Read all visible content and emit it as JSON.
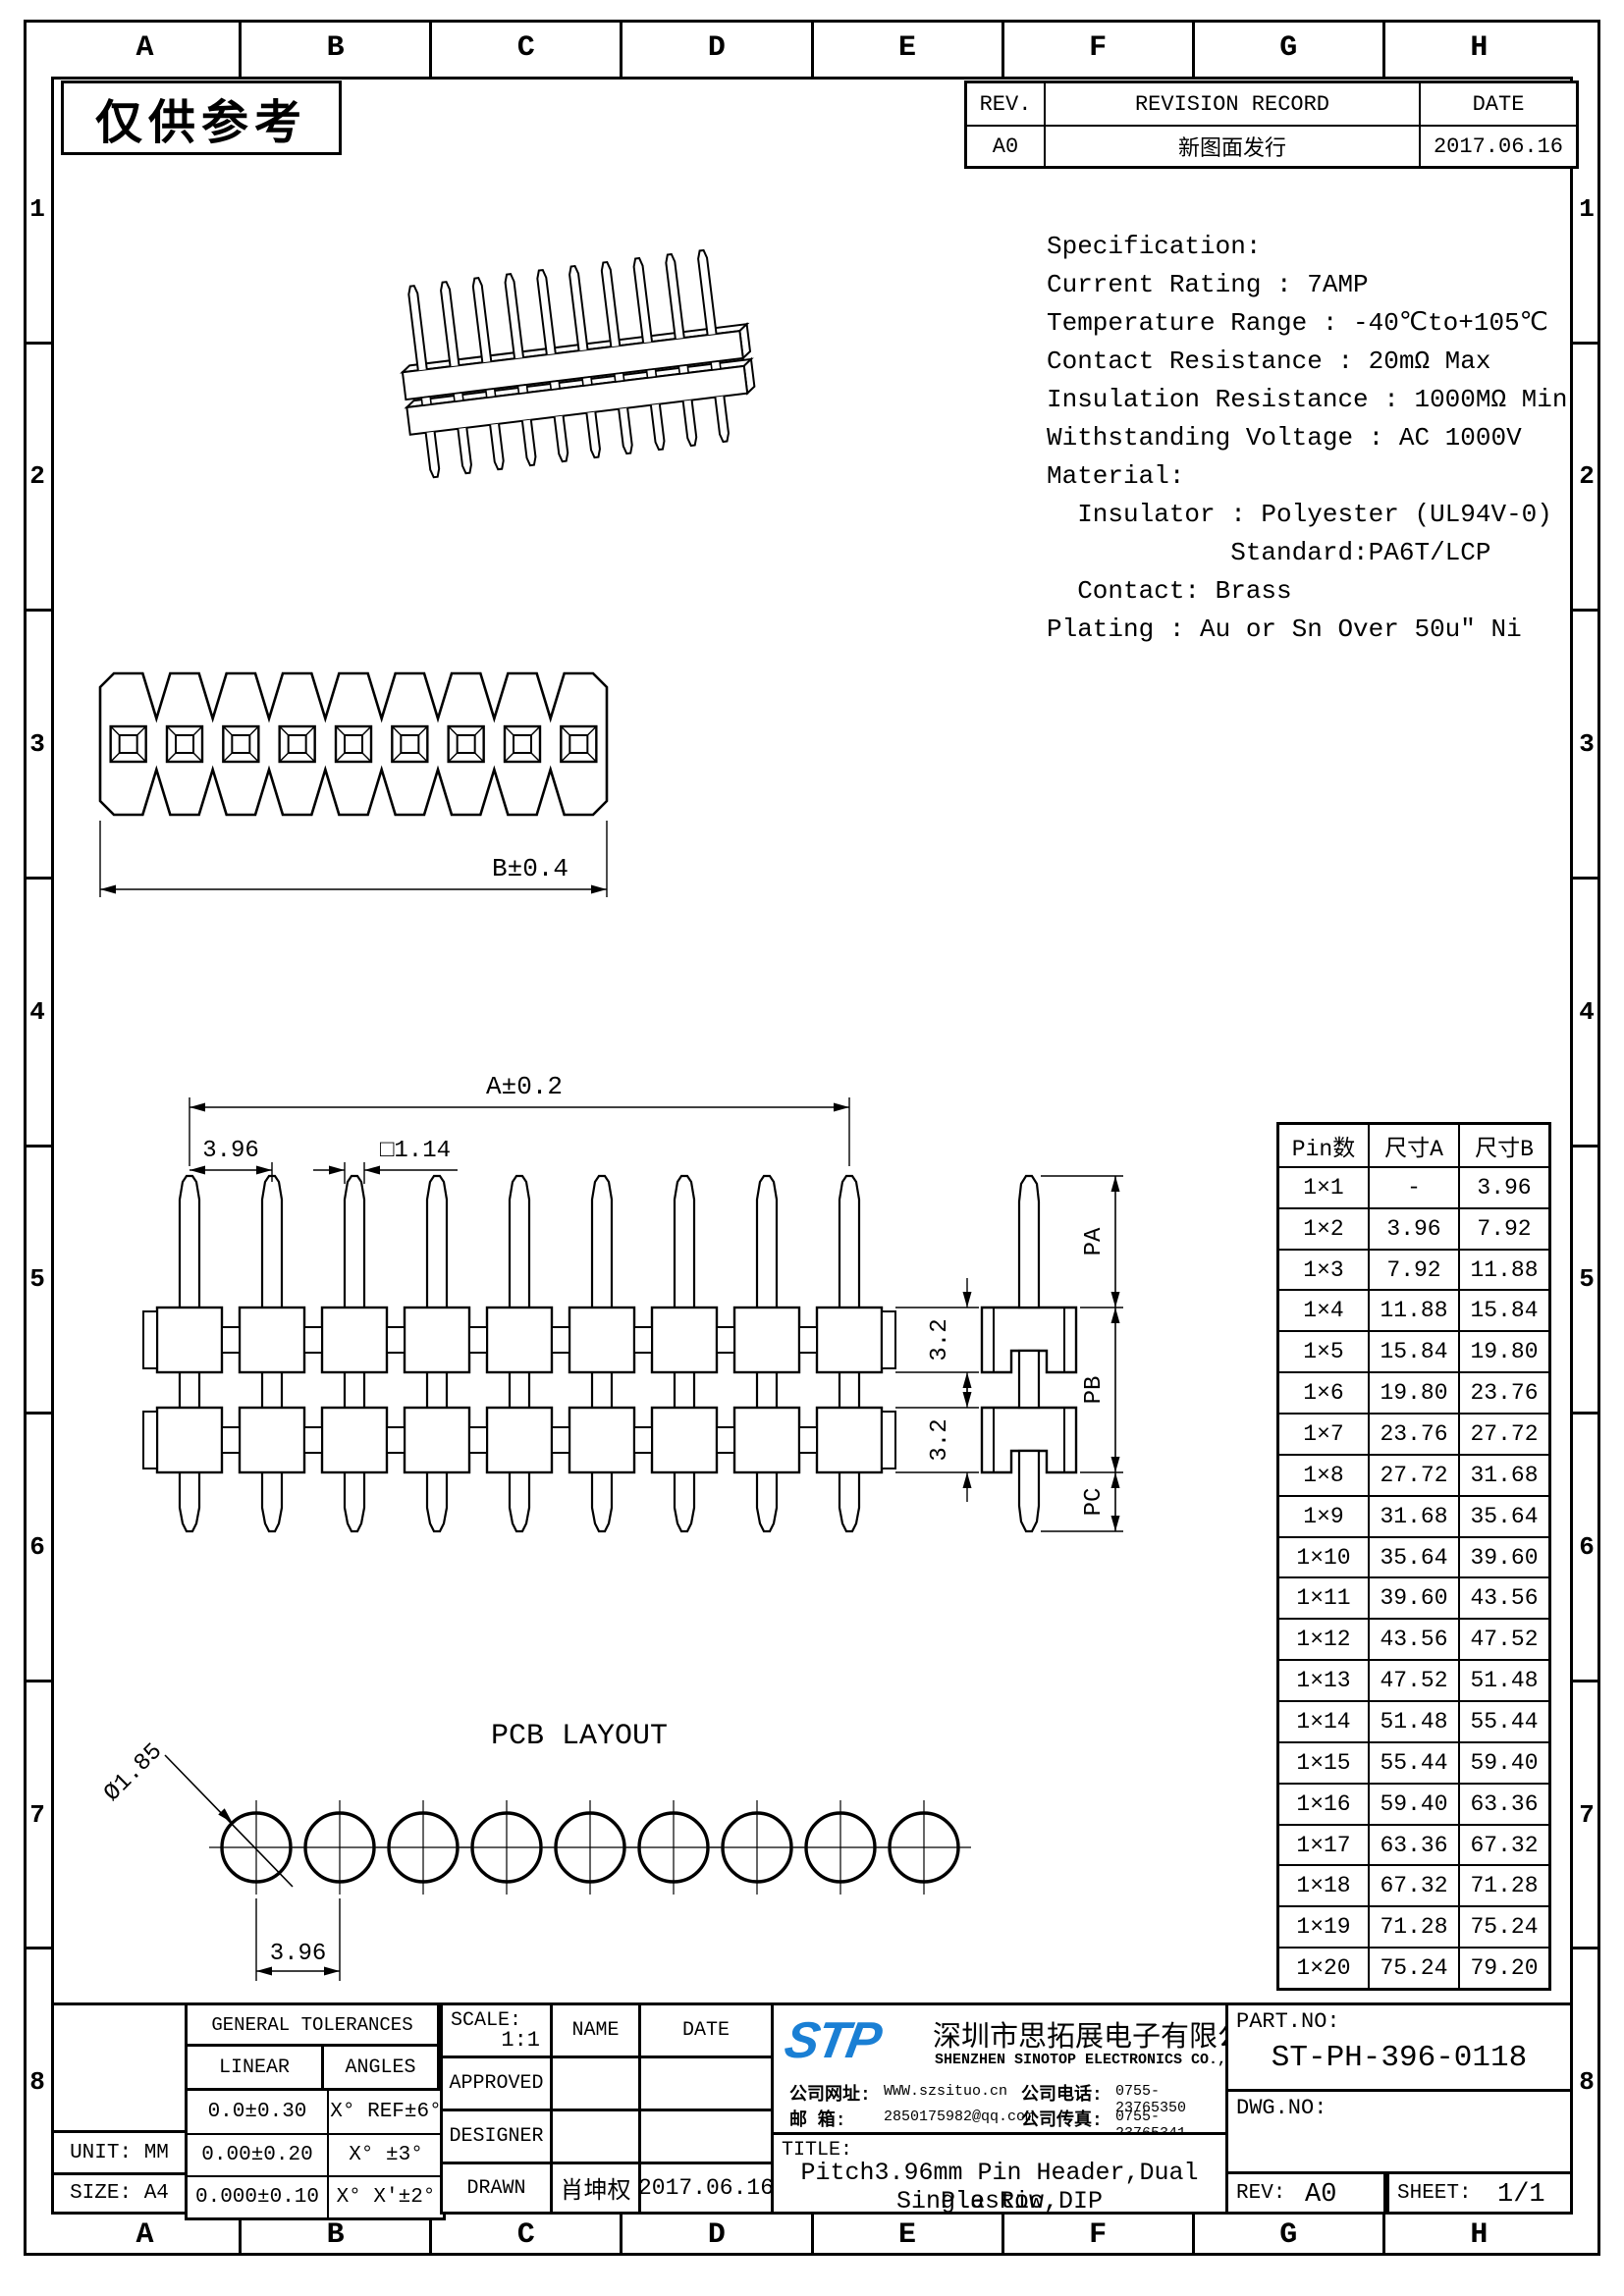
{
  "watermark": "仅供参考",
  "grid": {
    "cols": [
      "A",
      "B",
      "C",
      "D",
      "E",
      "F",
      "G",
      "H"
    ],
    "rows": [
      "1",
      "2",
      "3",
      "4",
      "5",
      "6",
      "7",
      "8"
    ]
  },
  "revision_table": {
    "headers": [
      "REV.",
      "REVISION RECORD",
      "DATE"
    ],
    "rows": [
      [
        "A0",
        "新图面发行",
        "2017.06.16"
      ]
    ]
  },
  "specification": {
    "lines": [
      "Specification:",
      "Current Rating : 7AMP",
      "Temperature Range : -40℃to+105℃",
      "Contact Resistance : 20mΩ Max",
      "Insulation Resistance : 1000MΩ Min",
      "Withstanding Voltage : AC 1000V",
      "Material:",
      "  Insulator : Polyester (UL94V-0)",
      "            Standard:PA6T/LCP",
      "  Contact: Brass",
      "Plating : Au or Sn Over 50u″ Ni"
    ]
  },
  "drawings": {
    "top_view": {
      "pins": 9,
      "dim_b": "B±0.4"
    },
    "front_view": {
      "pins": 9,
      "dim_a": "A±0.2",
      "dim_pitch": "3.96",
      "dim_pin": "□1.14",
      "dim_h_upper": "3.2",
      "dim_h_lower": "3.2"
    },
    "side_view": {
      "label_pa": "PA",
      "label_pb": "PB",
      "label_pc": "PC"
    },
    "pcb_layout": {
      "title": "PCB LAYOUT",
      "holes": 9,
      "hole_dia": "Ø1.85",
      "pitch": "3.96"
    },
    "iso_view": {
      "pins": 10
    }
  },
  "pin_table": {
    "headers": [
      "Pin数",
      "尺寸A",
      "尺寸B"
    ],
    "rows": [
      [
        "1×1",
        "-",
        "3.96"
      ],
      [
        "1×2",
        "3.96",
        "7.92"
      ],
      [
        "1×3",
        "7.92",
        "11.88"
      ],
      [
        "1×4",
        "11.88",
        "15.84"
      ],
      [
        "1×5",
        "15.84",
        "19.80"
      ],
      [
        "1×6",
        "19.80",
        "23.76"
      ],
      [
        "1×7",
        "23.76",
        "27.72"
      ],
      [
        "1×8",
        "27.72",
        "31.68"
      ],
      [
        "1×9",
        "31.68",
        "35.64"
      ],
      [
        "1×10",
        "35.64",
        "39.60"
      ],
      [
        "1×11",
        "39.60",
        "43.56"
      ],
      [
        "1×12",
        "43.56",
        "47.52"
      ],
      [
        "1×13",
        "47.52",
        "51.48"
      ],
      [
        "1×14",
        "51.48",
        "55.44"
      ],
      [
        "1×15",
        "55.44",
        "59.40"
      ],
      [
        "1×16",
        "59.40",
        "63.36"
      ],
      [
        "1×17",
        "63.36",
        "67.32"
      ],
      [
        "1×18",
        "67.32",
        "71.28"
      ],
      [
        "1×19",
        "71.28",
        "75.24"
      ],
      [
        "1×20",
        "75.24",
        "79.20"
      ]
    ]
  },
  "title_block": {
    "tolerances": {
      "title": "GENERAL TOLERANCES",
      "linear_label": "LINEAR",
      "angles_label": "ANGLES",
      "rows": [
        [
          "0.0±0.30",
          "X° REF±6°"
        ],
        [
          "0.00±0.20",
          "X° ±3°"
        ],
        [
          "0.000±0.10",
          "X° X'±2°"
        ]
      ]
    },
    "unit": "UNIT: MM",
    "size": "SIZE: A4",
    "scale_label": "SCALE:",
    "scale_value": "1:1",
    "name_label": "NAME",
    "date_label": "DATE",
    "approved_label": "APPROVED",
    "designer_label": "DESIGNER",
    "drawn_label": "DRAWN",
    "drawn_name": "肖坤权",
    "drawn_date": "2017.06.16",
    "company": {
      "logo": "STP",
      "logo_color": "#1a7fd4",
      "name_cn": "深圳市思拓展电子有限公司",
      "name_en": "SHENZHEN SINOTOP ELECTRONICS CO.,LTD",
      "website_label": "公司网址:",
      "website": "WWW.szsituo.cn",
      "phone_label": "公司电话:",
      "phone": "0755-23765350",
      "email_label": "邮  箱:",
      "email": "2850175982@qq.com",
      "fax_label": "公司传真:",
      "fax": "0755-23765341"
    },
    "part_no_label": "PART.NO:",
    "part_no": "ST-PH-396-0118",
    "dwg_no_label": "DWG.NO:",
    "title_label": "TITLE:",
    "title_line1": "Pitch3.96mm Pin Header,Dual Plastic,",
    "title_line2": "Single Row,DIP",
    "rev_label": "REV:",
    "rev_value": "A0",
    "sheet_label": "SHEET:",
    "sheet_value": "1/1"
  }
}
